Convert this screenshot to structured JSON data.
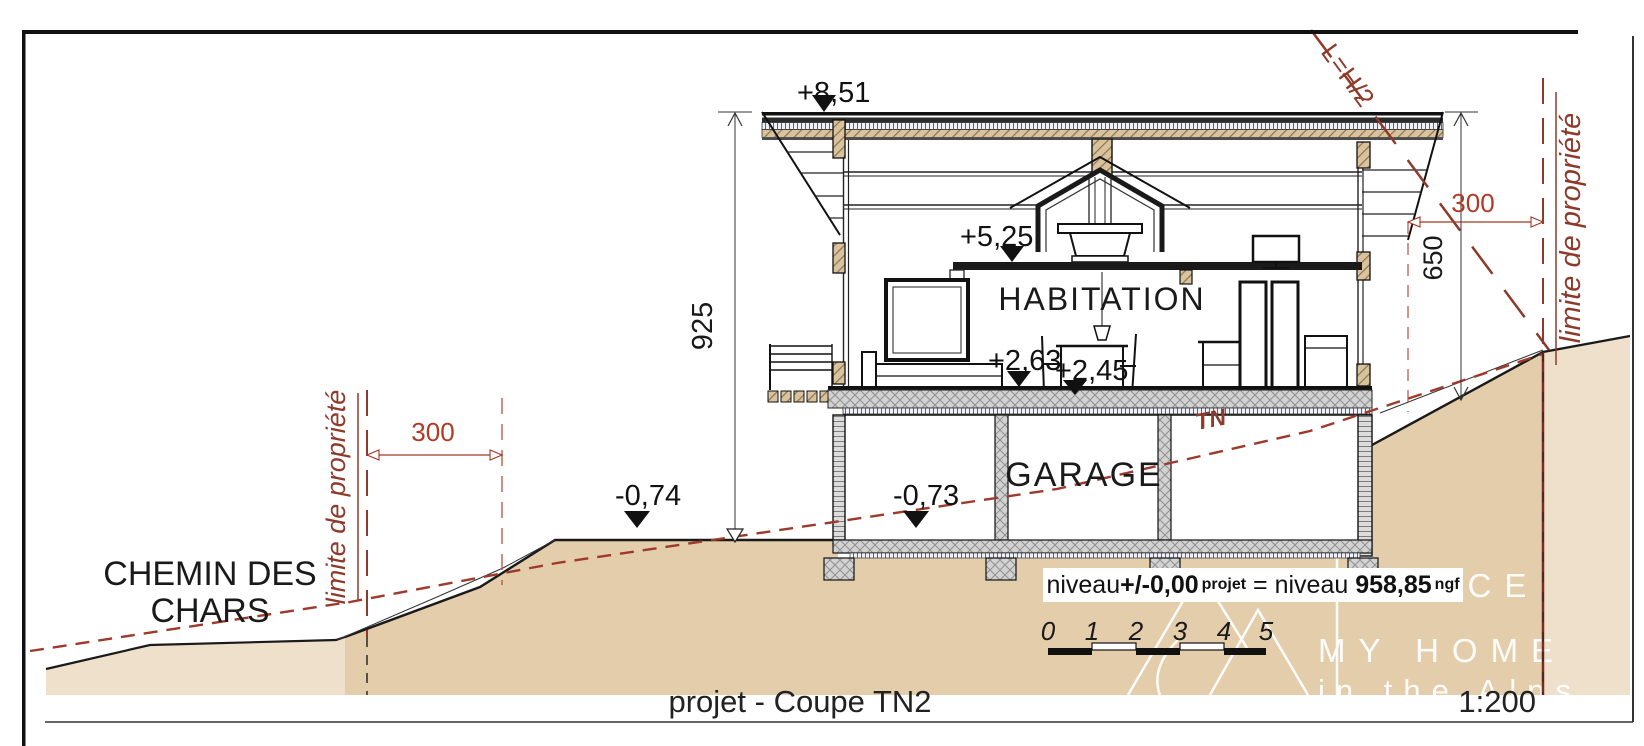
{
  "drawing": {
    "title": "projet - Coupe TN2",
    "scale": "1:200"
  },
  "labels": {
    "road_line1": "CHEMIN DES",
    "road_line2": "CHARS",
    "habitation": "HABITATION",
    "garage": "GARAGE",
    "natural_terrain": "TN",
    "height_rule": "L=H/2",
    "property_limit_left": "limite de propriété",
    "property_limit_right": "limite de propriété"
  },
  "levels": {
    "roof_ridge": "+8,51",
    "mezzanine": "+5,25",
    "floor_main": "+2,63",
    "floor_terrace": "+2,45",
    "ground_court": "-0,74",
    "garage_floor": "-0,73"
  },
  "dimensions": {
    "total_height": "925",
    "right_height": "650",
    "setback_left": "300",
    "setback_right": "300"
  },
  "level_note": {
    "prefix": "niveau ",
    "project_value": "+/-0,00",
    "project_unit": "projet",
    "equals": " = niveau ",
    "ngf_value": "958,85",
    "ngf_unit": "ngf"
  },
  "scale_bar": {
    "t0": "0",
    "t1": "1",
    "t2": "2",
    "t3": "3",
    "t4": "4",
    "t5": "5"
  },
  "watermark": {
    "line1": "AGENCE",
    "line2": "MY HOME",
    "line3": "in the Alps"
  },
  "colors": {
    "annotation_red": "#8e3a2b",
    "dim_red": "#b03a26",
    "terrain_fill": "#e3cdab",
    "terrain_light": "#eee0cb"
  }
}
